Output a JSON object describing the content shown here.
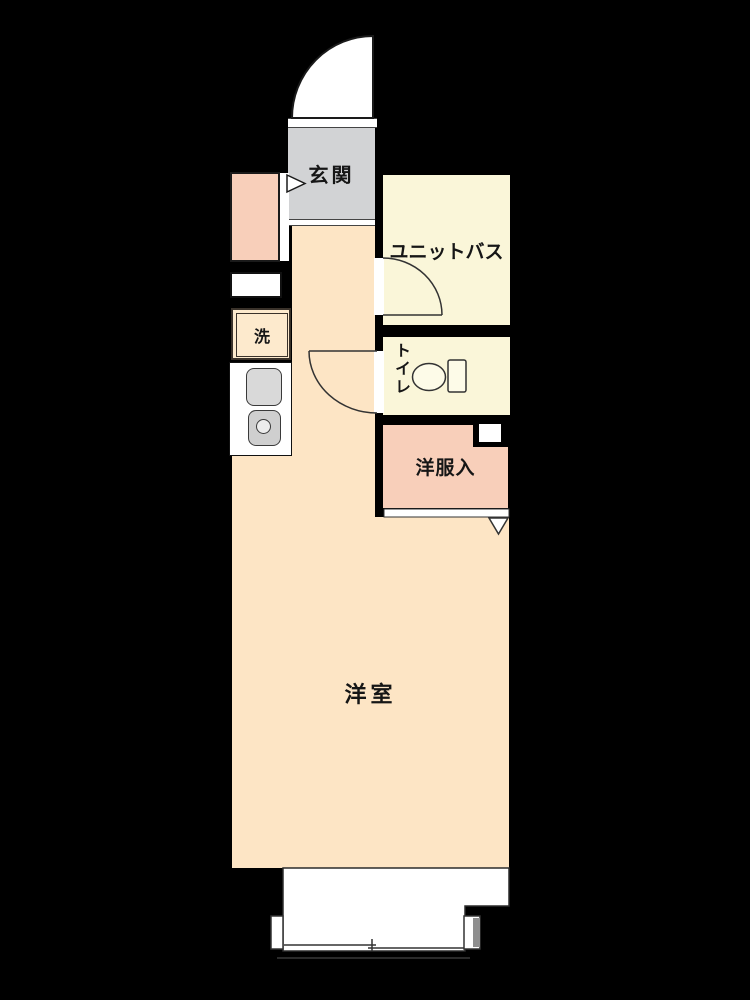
{
  "plan_type": "apartment-floorplan",
  "rooms": {
    "genkan": {
      "label": "玄関",
      "color": "#d2d3d5"
    },
    "unit_bath": {
      "label": "ユニットバス",
      "color": "#faf6d9"
    },
    "toilet": {
      "label": "トイレ",
      "color": "#faf6d9"
    },
    "closet": {
      "label": "洋服入",
      "color": "#f8cfba"
    },
    "washer": {
      "label": "洗",
      "color": "#fdeacd"
    },
    "main_room": {
      "label": "洋室",
      "color": "#fde5c5"
    },
    "corridor": {
      "color": "#fde5c5"
    },
    "shoe_cabinet": {
      "color": "#f8cfba"
    },
    "balcony": {
      "color": "#ffffff"
    }
  },
  "colors": {
    "background": "#000000",
    "wall": "#000000",
    "outline": "#1a1a1a",
    "kitchen_unit": "#ffffff",
    "fixture_gray": "#d6d6d6",
    "threshold_white": "#ffffff"
  },
  "icons": {
    "entrance_door": "quarter-circle-door-swing",
    "bath_door": "quarter-circle-door-swing",
    "toilet_door": "quarter-circle-door-swing",
    "toilet_fixture": "toilet-bowl-with-tank",
    "entrance_step": "right-pointing-triangle",
    "closet_door_mark": "down-v-mark",
    "sink": "rounded-square",
    "stove": "rounded-square-with-burner",
    "balcony_window": "sliding-window-lines"
  }
}
